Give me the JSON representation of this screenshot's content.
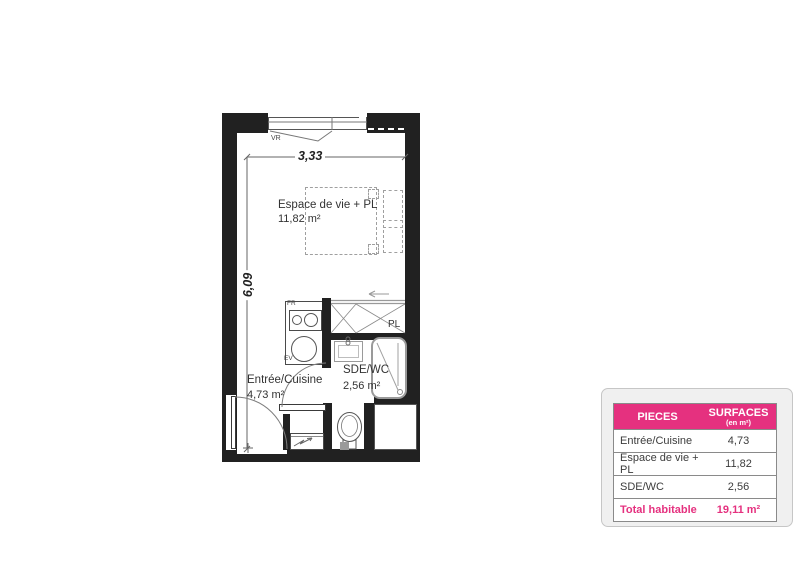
{
  "plan": {
    "rooms": {
      "living": {
        "name": "Espace de vie + PL",
        "area": "11,82 m²"
      },
      "entry": {
        "name": "Entrée/Cuisine",
        "area": "4,73 m²"
      },
      "bathroom": {
        "name": "SDE/WC",
        "area": "2,56 m²"
      }
    },
    "annotations": {
      "closet": "PL",
      "shutter": "VR",
      "fridge": "FR",
      "sink": "EV"
    },
    "dimensions": {
      "width": "3,33",
      "height": "6,09"
    }
  },
  "surface_table": {
    "header": {
      "pieces": "PIECES",
      "surfaces": "SURFACES",
      "surfaces_unit": "(en m²)"
    },
    "rows": [
      {
        "name": "Entrée/Cuisine",
        "value": "4,73"
      },
      {
        "name": "Espace de vie + PL",
        "value": "11,82"
      },
      {
        "name": "SDE/WC",
        "value": "2,56"
      }
    ],
    "total": {
      "label": "Total habitable",
      "value": "19,11 m²"
    },
    "accent_color": "#E5317F",
    "wall_color": "#212121"
  }
}
